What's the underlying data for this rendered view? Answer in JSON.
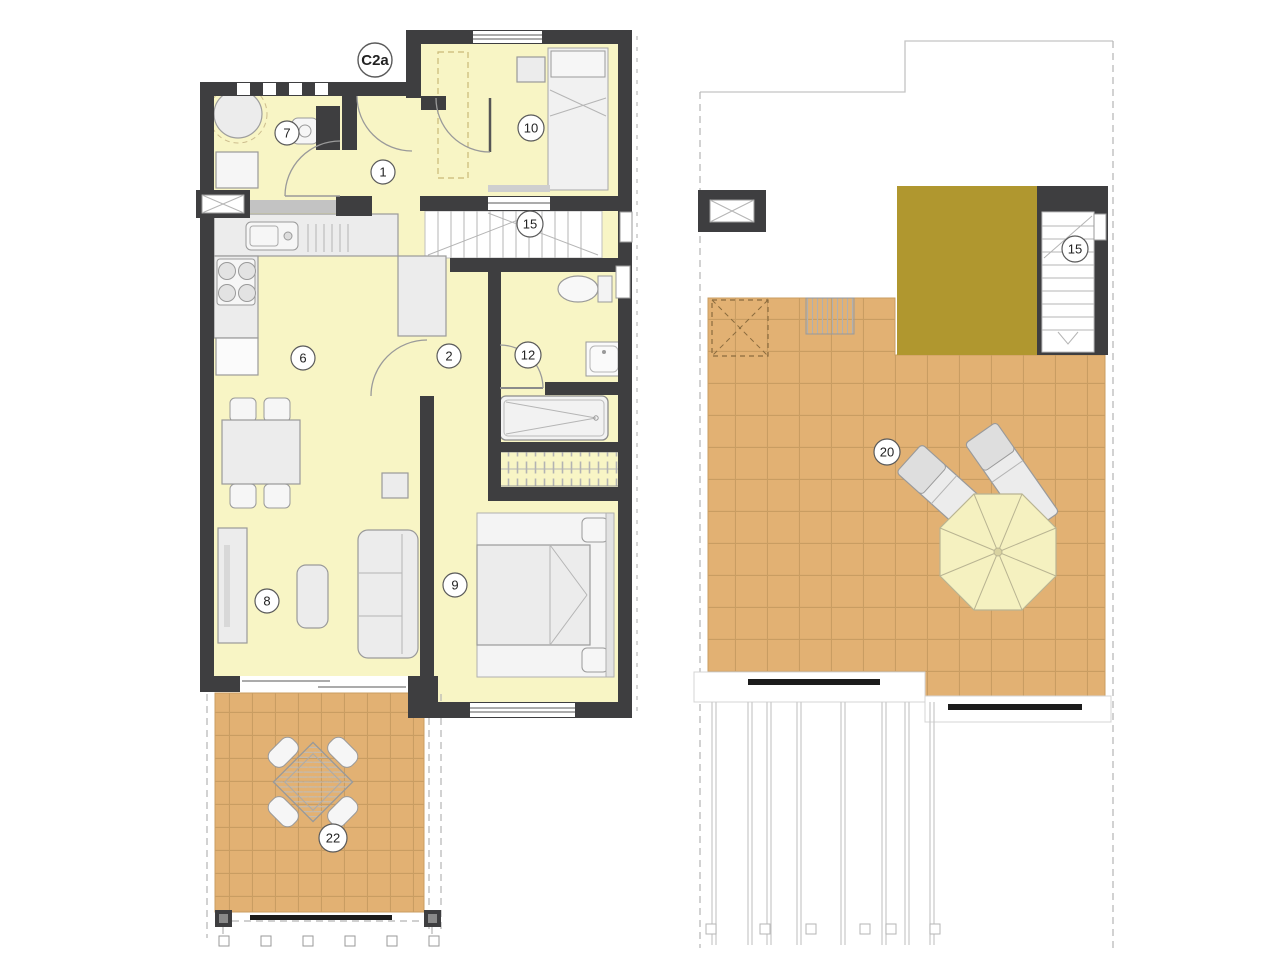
{
  "plan": {
    "unit_label": "C2a",
    "colors": {
      "wall": "#3e3e40",
      "floor": "#f8f5c5",
      "tile": "#e2b173",
      "tile_line": "#c99d62",
      "roof_block": "#b0972f",
      "furniture": "#ececec",
      "furniture_line": "#9a9a9a",
      "umbrella": "#f5f1c0",
      "railing": "#1c1c1c",
      "outline_dash": "#b5b5b5",
      "label_ring": "#5a5a5a",
      "ink": "#222222"
    },
    "levels": {
      "ground": {
        "name": "ground-floor",
        "labels": [
          {
            "room": "entry-hall",
            "text": "1"
          },
          {
            "room": "corridor",
            "text": "2"
          },
          {
            "room": "kitchen",
            "text": "6"
          },
          {
            "room": "bathroom-1",
            "text": "7"
          },
          {
            "room": "living-room",
            "text": "8"
          },
          {
            "room": "bedroom-main",
            "text": "9"
          },
          {
            "room": "bedroom-2",
            "text": "10"
          },
          {
            "room": "bathroom-2",
            "text": "12"
          },
          {
            "room": "staircase",
            "text": "15"
          },
          {
            "room": "terrace",
            "text": "22"
          }
        ]
      },
      "roof": {
        "name": "roof-terrace",
        "labels": [
          {
            "room": "staircase",
            "text": "15"
          },
          {
            "room": "solarium",
            "text": "20"
          }
        ]
      }
    }
  }
}
